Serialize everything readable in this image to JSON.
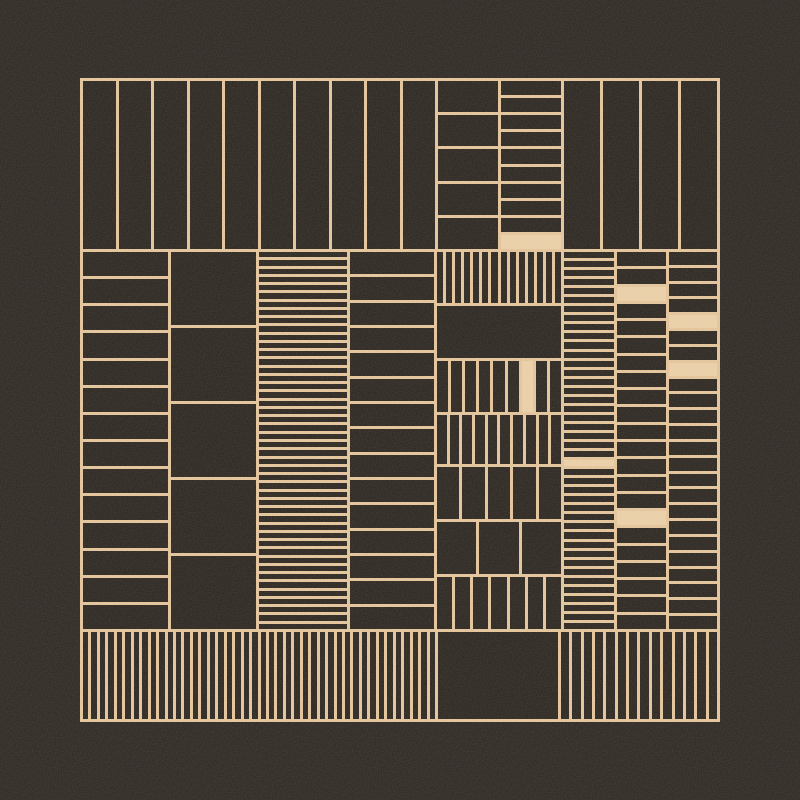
{
  "artwork": {
    "colors": {
      "background": "#2e2a27",
      "cell": "#2c2824",
      "line": "#e7c9a1",
      "fill": "#efd5ae"
    },
    "line_width": 3,
    "frame": {
      "x": 80,
      "y": 78,
      "w": 640,
      "h": 644
    },
    "panels": [
      {
        "name": "top-wide-stripes",
        "x": 83,
        "y": 81,
        "w": 352,
        "h": 168,
        "cols": 10,
        "rows": 1,
        "fills": []
      },
      {
        "name": "top-rows-medium",
        "x": 438,
        "y": 81,
        "w": 60,
        "h": 168,
        "cols": 1,
        "rows": 5,
        "fills": []
      },
      {
        "name": "top-rows-dense",
        "x": 501,
        "y": 81,
        "w": 60,
        "h": 168,
        "cols": 1,
        "rows": 10,
        "fills": [
          9
        ]
      },
      {
        "name": "top-right-stripes",
        "x": 564,
        "y": 81,
        "w": 153,
        "h": 168,
        "cols": 4,
        "rows": 1,
        "fills": []
      },
      {
        "name": "mid-left-rows",
        "x": 83,
        "y": 252,
        "w": 85,
        "h": 377,
        "cols": 1,
        "rows": 14,
        "fills": []
      },
      {
        "name": "mid-big-blocks",
        "x": 171,
        "y": 252,
        "w": 85,
        "h": 377,
        "cols": 1,
        "rows": 5,
        "fills": []
      },
      {
        "name": "mid-dense-hstripes",
        "x": 259,
        "y": 252,
        "w": 88,
        "h": 377,
        "cols": 1,
        "rows": 46,
        "fills": []
      },
      {
        "name": "mid-rows-medium",
        "x": 350,
        "y": 252,
        "w": 84,
        "h": 377,
        "cols": 1,
        "rows": 15,
        "fills": []
      },
      {
        "name": "center-vstripes-dense",
        "x": 437,
        "y": 252,
        "w": 124,
        "h": 51,
        "cols": 14,
        "rows": 1,
        "fills": []
      },
      {
        "name": "center-solid-block",
        "x": 437,
        "y": 306,
        "w": 124,
        "h": 52,
        "cols": 1,
        "rows": 1,
        "fills": []
      },
      {
        "name": "center-bars-a",
        "x": 437,
        "y": 361,
        "w": 124,
        "h": 51,
        "cols": 9,
        "rows": 1,
        "fills": [
          6
        ]
      },
      {
        "name": "center-bars-b",
        "x": 437,
        "y": 415,
        "w": 124,
        "h": 49,
        "cols": 10,
        "rows": 1,
        "fills": []
      },
      {
        "name": "center-bars-wide",
        "x": 437,
        "y": 467,
        "w": 124,
        "h": 52,
        "cols": 5,
        "rows": 1,
        "fills": []
      },
      {
        "name": "center-bars-widest",
        "x": 437,
        "y": 522,
        "w": 124,
        "h": 52,
        "cols": 3,
        "rows": 1,
        "fills": []
      },
      {
        "name": "center-bars-c",
        "x": 437,
        "y": 577,
        "w": 124,
        "h": 52,
        "cols": 7,
        "rows": 1,
        "fills": []
      },
      {
        "name": "right-ladder-dense",
        "x": 564,
        "y": 252,
        "w": 50,
        "h": 377,
        "cols": 1,
        "rows": 42,
        "fills": [
          23
        ]
      },
      {
        "name": "right-rows-mid",
        "x": 617,
        "y": 252,
        "w": 49,
        "h": 377,
        "cols": 1,
        "rows": 22,
        "fills": [
          2,
          15
        ]
      },
      {
        "name": "right-rows-outer",
        "x": 669,
        "y": 252,
        "w": 48,
        "h": 377,
        "cols": 1,
        "rows": 24,
        "fills": [
          4,
          7
        ]
      },
      {
        "name": "bottom-dense-stripes",
        "x": 83,
        "y": 632,
        "w": 352,
        "h": 87,
        "cols": 42,
        "rows": 1,
        "fills": []
      },
      {
        "name": "bottom-solid-block",
        "x": 438,
        "y": 632,
        "w": 120,
        "h": 87,
        "cols": 1,
        "rows": 1,
        "fills": []
      },
      {
        "name": "bottom-right-stripes",
        "x": 561,
        "y": 632,
        "w": 156,
        "h": 87,
        "cols": 14,
        "rows": 1,
        "fills": []
      }
    ]
  }
}
